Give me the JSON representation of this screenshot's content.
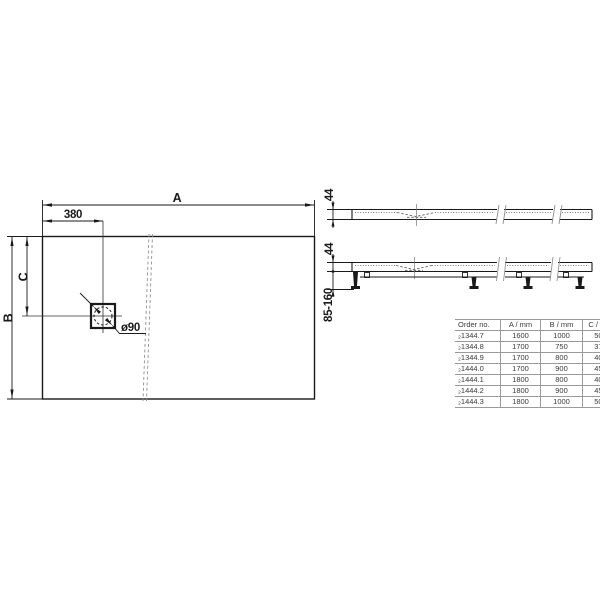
{
  "drawing": {
    "plan": {
      "dim_a_label": "A",
      "dim_380_label": "380",
      "dim_b_label": "B",
      "dim_c_label": "C",
      "drain_label": "ø90"
    },
    "side_top": {
      "height_label": "44"
    },
    "side_front": {
      "height_label": "44",
      "adjust_range_label": "85-160"
    }
  },
  "table": {
    "headers": {
      "order": "Order no.",
      "a": "A / mm",
      "b": "B / mm",
      "c": "C / mm"
    },
    "rows": [
      {
        "order": "₂1344.7",
        "a": "1600",
        "b": "1000",
        "c": "500"
      },
      {
        "order": "₂1344.8",
        "a": "1700",
        "b": "750",
        "c": "375"
      },
      {
        "order": "₂1344.9",
        "a": "1700",
        "b": "800",
        "c": "400"
      },
      {
        "order": "₂1444.0",
        "a": "1700",
        "b": "900",
        "c": "450"
      },
      {
        "order": "₂1444.1",
        "a": "1800",
        "b": "800",
        "c": "400"
      },
      {
        "order": "₂1444.2",
        "a": "1800",
        "b": "900",
        "c": "450"
      },
      {
        "order": "₂1444.3",
        "a": "1800",
        "b": "1000",
        "c": "500"
      }
    ]
  },
  "colors": {
    "line": "#1a1a1a",
    "break_line": "#8f8f8f",
    "grid": "#9a9a9a",
    "table_text": "#3a3a3a"
  }
}
